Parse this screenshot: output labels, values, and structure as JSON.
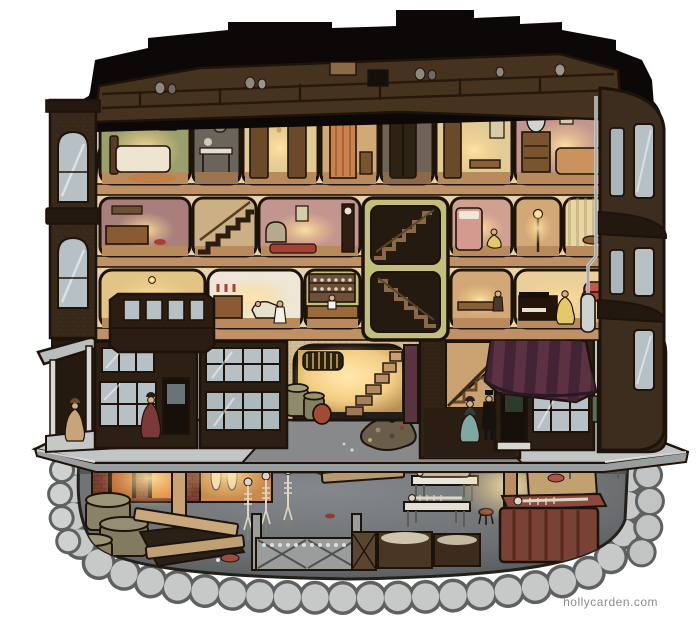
{
  "artwork": {
    "watermark": "hollycarden.com"
  },
  "palette": {
    "paper": "#ffffff",
    "ink": "#1d130b",
    "roof": "#0b0807",
    "attic": "#46331f",
    "interior": "#e9d2a9",
    "floor_wood": "#c09066",
    "facade": "#3a2a1b",
    "trim": "#231810",
    "tower": "#3d2d1e",
    "window_pane": "#b7c0c4",
    "storefront": "#2c1f13",
    "arch_wall": "#d2bd96",
    "sidewalk": "#c2c5c5",
    "sidewalk_face": "#9a9e9f",
    "street": "#87898b",
    "basement_mid": "#6e7173",
    "stone": "#c7c9c8",
    "stone_shadow": "#686b69",
    "awning": "#5c3242",
    "awning_stripe": "#3e2232",
    "oven_brick": "#7e4030",
    "coffin": "#7a4136",
    "glow_warm": "#ffd98f",
    "room_green": "#9aa06d",
    "room_mauve": "#a97f7c",
    "room_pink": "#c2968e",
    "room_yellow": "#e2c487",
    "room_olive": "#c3bd7e",
    "room_grey": "#6b645a",
    "room_cream": "#e3cb97",
    "room_tan": "#d3a877",
    "sofa_red": "#c4564a",
    "dress_teal": "#7fa8a2",
    "dress_red": "#7b3a3a",
    "dress_tan": "#c8a47b",
    "dress_yellow": "#e5c86a",
    "skeleton": "#ddd6c6",
    "plank": "#c8a87c",
    "watermark_grey": "#8d8d8d"
  }
}
